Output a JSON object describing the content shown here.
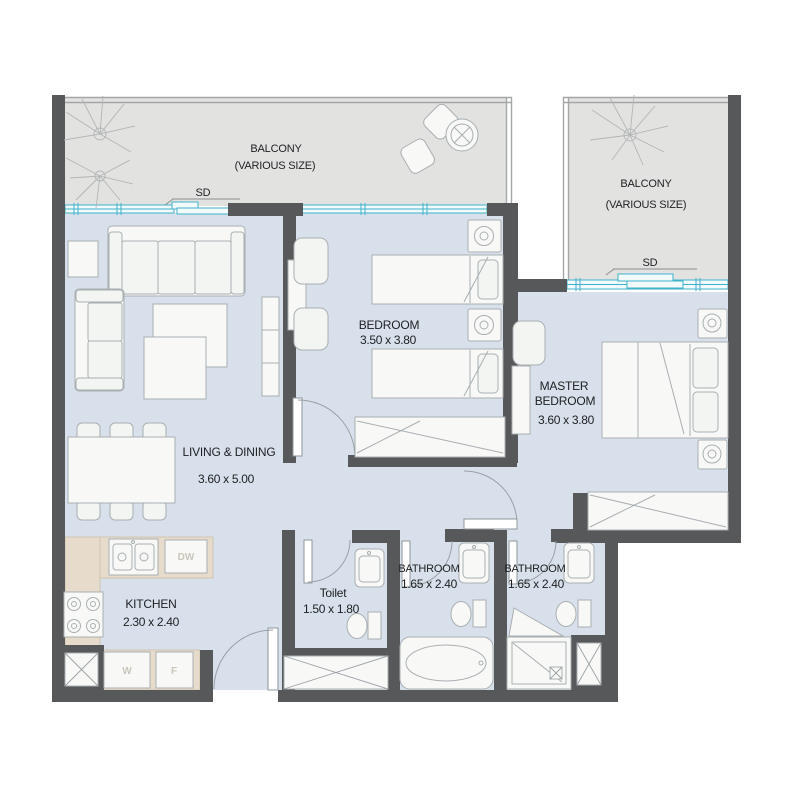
{
  "title": "2 bedroom apartment floor plan",
  "colors": {
    "wall": "#56585a",
    "floor": "#d8e1eb",
    "balcony_floor": "#e2e2e1",
    "kitchen_counter": "#e7dccb",
    "window_accent": "#3fb2ca",
    "furniture_line": "#a9aeb1",
    "text": "#1d1f22"
  },
  "balcony_left": {
    "name": "BALCONY",
    "size_note": "(VARIOUS SIZE)",
    "door_label": "SD"
  },
  "balcony_right": {
    "name": "BALCONY",
    "size_note": "(VARIOUS SIZE)",
    "door_label": "SD"
  },
  "rooms": {
    "living": {
      "name": "LIVING & DINING",
      "dims": "3.60 x 5.00"
    },
    "bedroom": {
      "name": "BEDROOM",
      "dims": "3.50 x 3.80"
    },
    "master": {
      "name_line1": "MASTER",
      "name_line2": "BEDROOM",
      "dims": "3.60 x 3.80"
    },
    "kitchen": {
      "name": "KITCHEN",
      "dims": "2.30 x 2.40"
    },
    "toilet": {
      "name": "Toilet",
      "dims": "1.50 x 1.80"
    },
    "bathroom1": {
      "name": "BATHROOM",
      "dims": "1.65 x 2.40"
    },
    "bathroom2": {
      "name": "BATHROOM",
      "dims": "1.65 x 2.40"
    }
  },
  "appliances": {
    "dishwasher": "DW",
    "washer": "W",
    "fridge": "F"
  }
}
